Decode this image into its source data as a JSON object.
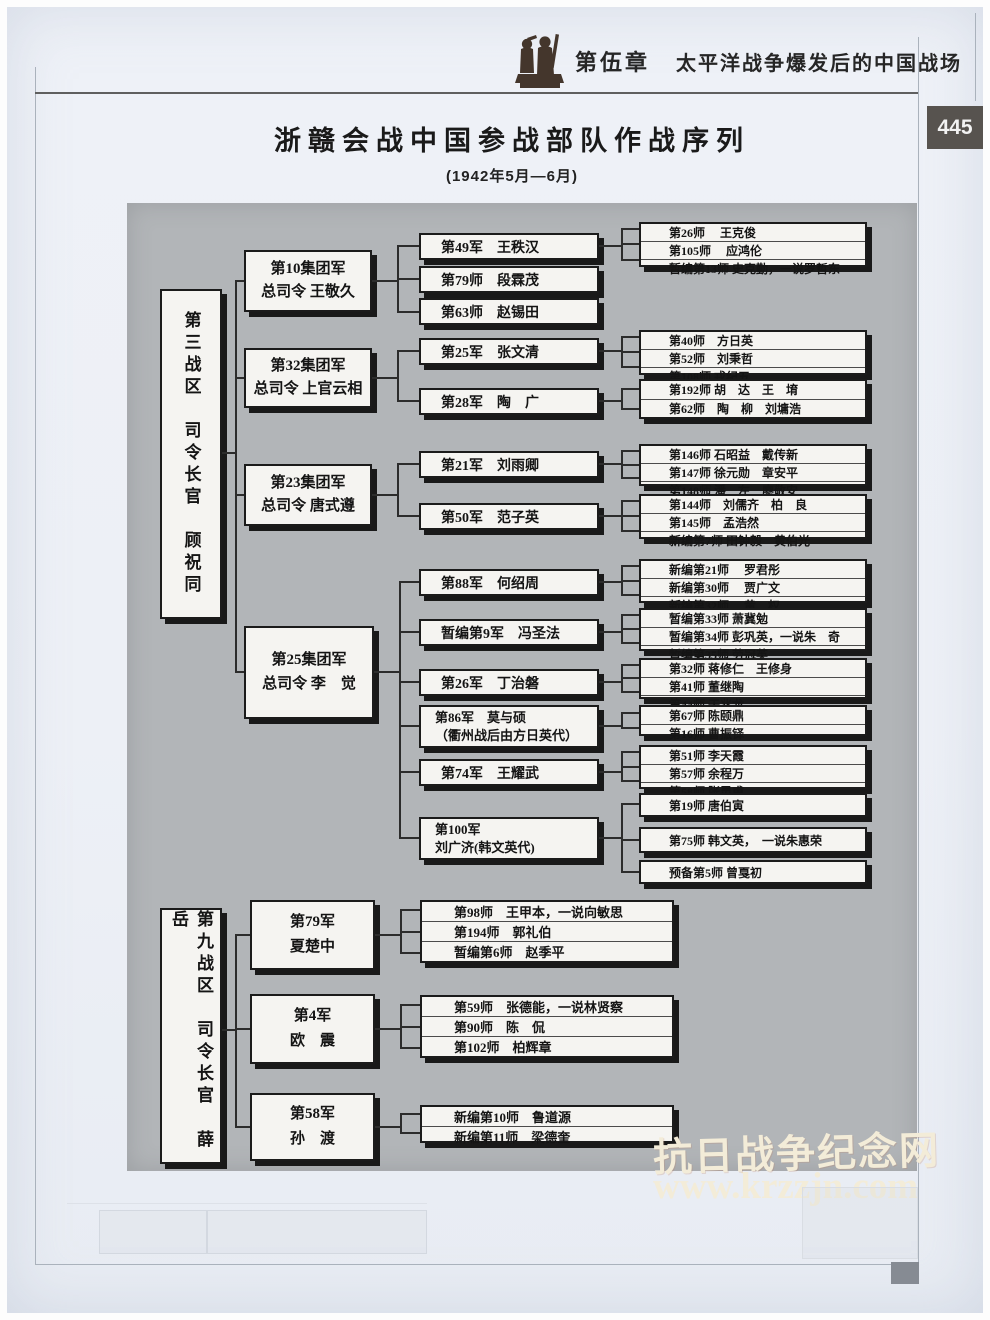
{
  "header": {
    "chapter": "第伍章",
    "chapter_title": "太平洋战争爆发后的中国战场",
    "page_number": "445",
    "emblem": "soldier-statue-icon"
  },
  "title": "浙赣会战中国参战部队作战序列",
  "subtitle": "(1942年5月—6月)",
  "colors": {
    "panel_gray": "#b2b5b8",
    "box_fill": "#f5f4f1",
    "box_shadow": "#191919",
    "page_number_badge": "#57534f",
    "watermark": "#f3ecd8"
  },
  "zone3": {
    "hq": "第三战区　司令长官　顾祝同",
    "group_armies": [
      {
        "name": "第10集团军",
        "commander": "总司令 王敬久"
      },
      {
        "name": "第32集团军",
        "commander": "总司令 上官云相"
      },
      {
        "name": "第23集团军",
        "commander": "总司令 唐式遵"
      },
      {
        "name": "第25集团军",
        "commander": "总司令 李　觉"
      }
    ],
    "armies": [
      {
        "l1": "第49军　王秩汉"
      },
      {
        "l1": "第79师　段霖茂"
      },
      {
        "l1": "第63师　赵锡田"
      },
      {
        "l1": "第25军　张文清"
      },
      {
        "l1": "第28军　陶　广"
      },
      {
        "l1": "第21军　刘雨卿"
      },
      {
        "l1": "第50军　范子英"
      },
      {
        "l1": "第88军　何绍周"
      },
      {
        "l1": "暂编第9军　冯圣法"
      },
      {
        "l1": "第26军　丁治磐"
      },
      {
        "l1": "第86军　莫与硕",
        "l2": "（衢州战后由方日英代）"
      },
      {
        "l1": "第74军　王耀武"
      },
      {
        "l1": "第100军",
        "l2": "刘广济(韩文英代)"
      }
    ],
    "division_groups": [
      {
        "rows": [
          "第26师　 王克俊",
          "第105师　 应鸿伦",
          "暂编第13师 史克勤，一说罗哲东"
        ]
      },
      {
        "rows": [
          "第40师　方日英",
          "第52师　刘秉哲",
          "第108师 戎纪五"
        ]
      },
      {
        "rows": [
          "第192师 胡　达　王　堉",
          "第62师　陶　柳　刘墉浩"
        ]
      },
      {
        "rows": [
          "第146师 石昭益　戴传新",
          "第147师 徐元勋　章安平",
          "第148师 潘　左　廖敬安"
        ]
      },
      {
        "rows": [
          "第144师　刘儒齐　柏　良",
          "第145师　孟浩然",
          "新编第7师 田钟毅　黄伯光"
        ]
      },
      {
        "rows": [
          "新编第21师　 罗君彤",
          "新编第30师　 贾广文",
          "新编第32师　 黄　权"
        ]
      },
      {
        "rows": [
          "暂编第33师 萧冀勉",
          "暂编第34师 彭巩英，一说朱　奇",
          "暂编第35师 劳冠英"
        ]
      },
      {
        "rows": [
          "第32师 蒋修仁　王修身",
          "第41师 董继陶",
          "第44师 于兆龙"
        ]
      },
      {
        "rows": [
          "第67师 陈颐鼎",
          "第16师 曹振铎"
        ]
      },
      {
        "rows": [
          "第51师 李天霞",
          "第57师 余程万",
          "第58师 张灵甫"
        ]
      },
      {
        "rows": [
          "第19师 唐伯寅"
        ]
      },
      {
        "rows": [
          "第75师 韩文英，　一说朱惠荣"
        ]
      },
      {
        "rows": [
          "预备第5师 曾戛初"
        ]
      }
    ]
  },
  "zone9": {
    "hq": "第九战区　司令长官　薛　岳",
    "armies": [
      {
        "name": "第79军",
        "commander": "夏楚中"
      },
      {
        "name": "第4军",
        "commander": "欧　震"
      },
      {
        "name": "第58军",
        "commander": "孙　渡"
      }
    ],
    "division_groups": [
      {
        "rows": [
          "第98师　王甲本，一说向敏思",
          "第194师　郭礼伯",
          "暂编第6师　赵季平"
        ]
      },
      {
        "rows": [
          "第59师　张德能，一说林贤察",
          "第90师　陈　侃",
          "第102师　柏辉章"
        ]
      },
      {
        "rows": [
          "新编第10师　鲁道源",
          "新编第11师　梁德奎"
        ]
      }
    ]
  },
  "watermark": {
    "site_name": "抗日战争纪念网",
    "site_url": "www.krzzjn.com"
  }
}
